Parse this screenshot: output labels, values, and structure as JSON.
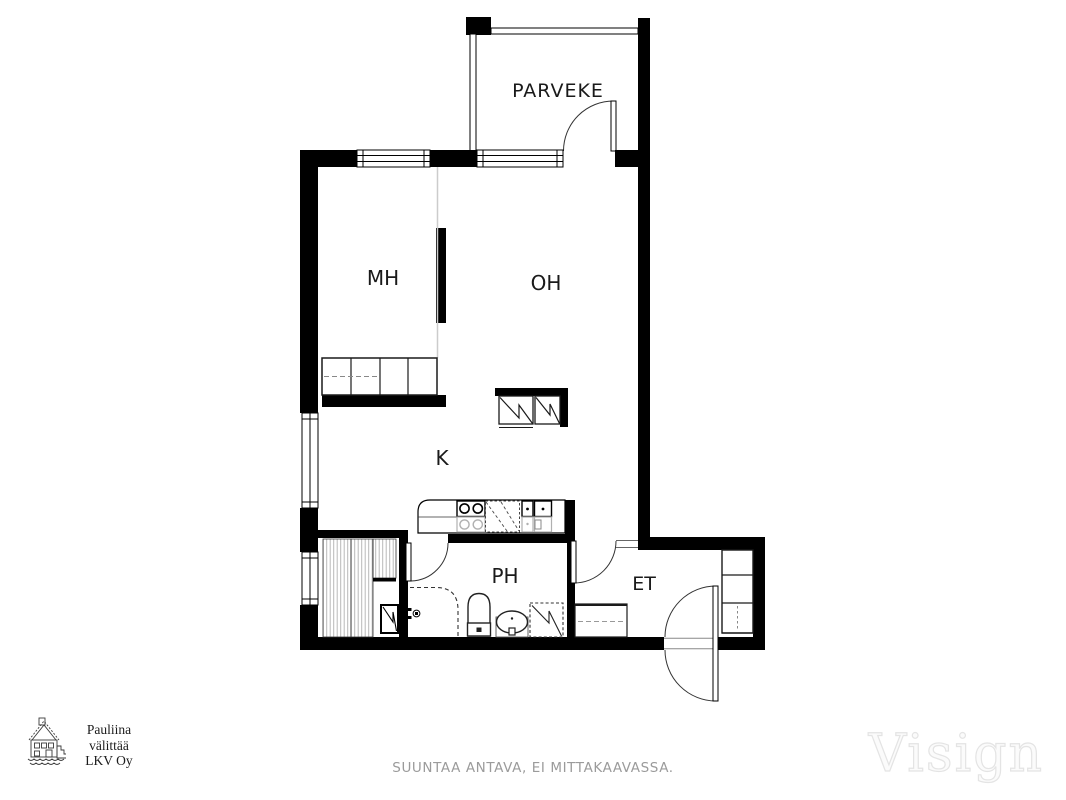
{
  "colors": {
    "wall": "#000000",
    "line": "#1a1a1a",
    "muted": "#9b9b9b",
    "watermark_outline": "#e4e4e4",
    "hatch": "#b8b8b8"
  },
  "plan": {
    "rooms": {
      "balcony": "PARVEKE",
      "bedroom": "MH",
      "living_room": "OH",
      "kitchen": "K",
      "bathroom": "PH",
      "entry": "ET"
    }
  },
  "footer": {
    "agency_logo": {
      "line1": "Pauliina",
      "line2": "välittää",
      "line3": "LKV Oy"
    },
    "disclaimer": "SUUNTAA ANTAVA, EI MITTAKAAVASSA.",
    "watermark": "Visign"
  }
}
